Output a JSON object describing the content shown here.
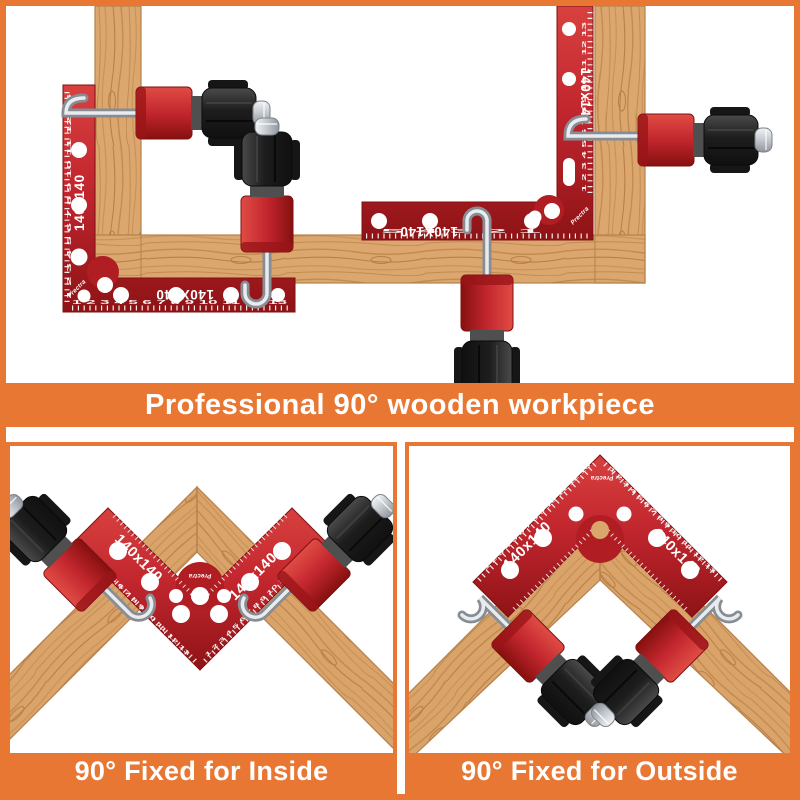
{
  "frame": {
    "border_color": "#E87733",
    "background": "#FFFFFF"
  },
  "product": {
    "brand": "Prectra",
    "size_label": "140x140",
    "size_label_caps": "140X140",
    "ruler_long": "1 2 3 4 5 6 7 8 9 10 11 12 13",
    "ruler_short": "5 4 3 2 1",
    "colors": {
      "square_red": "#C2262E",
      "wood_tan": "#DCA76E",
      "knob_black": "#222222",
      "steel_silver": "#C9CED3",
      "accent_orange": "#E87733"
    }
  },
  "captions": {
    "top": "Professional 90° wooden workpiece",
    "bottom_left": "90° Fixed for Inside",
    "bottom_right": "90° Fixed for Outside"
  }
}
